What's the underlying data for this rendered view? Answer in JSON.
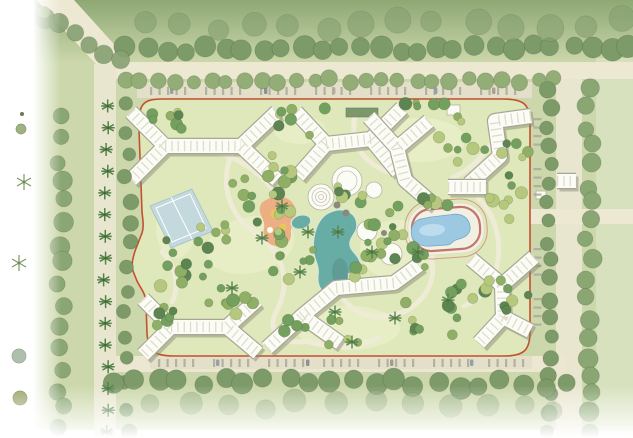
{
  "artwork": {
    "kind": "residential community landscape master plan (site plan rendering)",
    "visible_text": "none"
  },
  "site": {
    "boundary_color": "#c4502f",
    "building_count": 9,
    "amenities": [
      {
        "name": "tennis-courts",
        "color": "#c3d9de"
      },
      {
        "name": "children-playground",
        "color": "#ecab80"
      },
      {
        "name": "clubhouse-pavilions",
        "color": "#fcfcf7"
      },
      {
        "name": "central-lagoon",
        "color": "#68aca6"
      },
      {
        "name": "swimming-pool-with-track",
        "color": "#9dc8e2",
        "track_color": "#c4756a"
      }
    ],
    "palette": {
      "street_tree": "#7d9a69",
      "interior_trees": [
        "#5d8551",
        "#74a05f",
        "#8fae66",
        "#b6c87d"
      ],
      "lawn": "#e8efc8",
      "ground": "#dfe8ba",
      "road": "#ece8d1",
      "building": "#fcfcf7",
      "water_edge": "#74a8c6"
    }
  }
}
